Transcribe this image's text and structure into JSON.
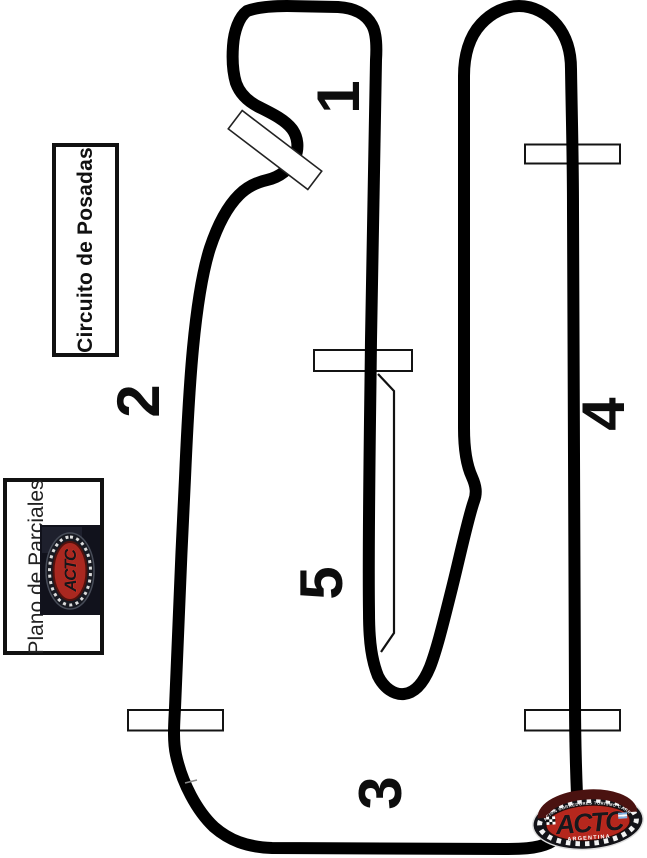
{
  "titles": {
    "circuit": "Circuito de Posadas",
    "plan": "Plano de Parciales"
  },
  "sectors": [
    {
      "label": "1"
    },
    {
      "label": "2"
    },
    {
      "label": "3"
    },
    {
      "label": "4"
    },
    {
      "label": "5"
    }
  ],
  "sector_markers": {
    "count": 5,
    "description": "white rectangles crossing the track marking sector boundaries"
  },
  "logo": {
    "acronym": "ACTC",
    "country": "ARGENTINA",
    "full_name_arc": "ASOCIACION CORREDORES TURISMO CARRETERA",
    "acronym_small": "ACTC"
  },
  "colors": {
    "background": "#ffffff",
    "track": "#000000",
    "marker_fill": "#ffffff",
    "marker_border": "#141414",
    "text": "#0d0d0d",
    "logo_red": "#b5271d",
    "logo_dark": "#131318",
    "flag_blue": "#7fb2e5"
  }
}
